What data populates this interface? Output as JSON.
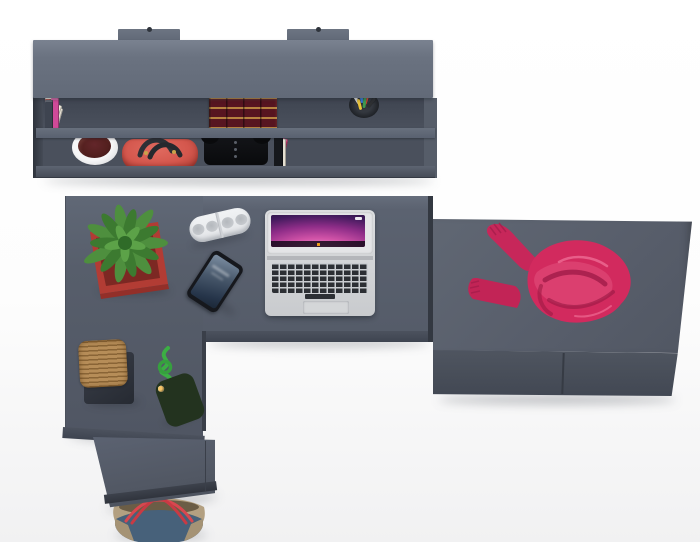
{
  "scene": {
    "type": "3d-furniture-render-top-view",
    "objects": [
      "wall-shelf-unit",
      "mount-brackets",
      "books",
      "classic-book-set",
      "pen-cup",
      "white-flower-pot",
      "red-handbag",
      "black-audio-device",
      "l-shaped-desk",
      "succulent-plant",
      "red-planter",
      "bluetooth-speaker",
      "macbook-laptop",
      "smartphone",
      "twine-stool",
      "bead-pouch-toy",
      "green-cord",
      "pedestal-cabinet",
      "tote-bag",
      "ottoman-cabinet",
      "pink-sweater"
    ]
  },
  "colors": {
    "bg": "#ffffff",
    "bg_floor": "#f1f1f2",
    "unit_top": "#6a7280",
    "surface": "#5b6270",
    "recess": "#4a505c",
    "edge": "#4c525e",
    "edge_dark": "#363b45",
    "classic_book": "#571520",
    "classic_gold": "#d6a64a",
    "pot_red": "#b23c34",
    "pot_red_dark": "#7c2823",
    "leaf1": "#4e8f3e",
    "leaf2": "#3c7a30",
    "leaf3": "#5ca248",
    "leaf4": "#2f6b28",
    "sweater": "#d22a5e",
    "sweater_dark": "#9c1a45",
    "sweater_hi": "#ee6b93",
    "bag_red": "#d4574d",
    "bag_handle": "#2d3036",
    "speaker_body": "#eceef0",
    "speaker_grille": "#c6c9cd",
    "laptop_body": "#d6d8da",
    "laptop_key": "#2c2f34",
    "phone_body": "#16181d",
    "twine": "#b68d58",
    "stool_base": "#30353e",
    "cord_green": "#3cae44",
    "tote_denim": "#47617a",
    "tote_tan": "#b3a081",
    "tote_handle": "#d8474f",
    "pot_white": "#f2f2f3",
    "pot_plant": "#54201f",
    "device_black": "#0e0f12",
    "screen_pink1": "#f4a8d8",
    "screen_pink2": "#d253a8",
    "screen_purple": "#8e2d88",
    "screen_deep": "#431b5e",
    "screen_dark": "#1c0f33"
  },
  "shelf": {
    "books_row1": [
      {
        "c": "#e9e4d6",
        "w": 7,
        "h": 34
      },
      {
        "c": "#7b52b2",
        "w": 8,
        "h": 32
      },
      {
        "c": "#9aa0a8",
        "w": 4,
        "h": 29
      },
      {
        "c": "#efe9dc",
        "w": 8,
        "h": 35
      },
      {
        "c": "#d9cfae",
        "w": 6,
        "h": 31
      },
      {
        "c": "#c0392f",
        "w": 5,
        "h": 33
      },
      {
        "c": "#2d3138",
        "w": 7,
        "h": 30
      },
      {
        "c": "#e8e3d8",
        "w": 7,
        "h": 27,
        "r": 16,
        "g": 4
      },
      {
        "c": "#ddd3bc",
        "w": 8,
        "h": 29,
        "r": 18
      },
      {
        "c": "#f0ead8",
        "w": 7,
        "h": 31,
        "r": 20
      },
      {
        "c": "#d04a98",
        "w": 8,
        "h": 35,
        "g": 6
      },
      {
        "c": "#c02e8a",
        "w": 6,
        "h": 33
      },
      {
        "c": "#684fa0",
        "w": 7,
        "h": 31
      },
      {
        "c": "#2e8f8a",
        "w": 6,
        "h": 34
      },
      {
        "c": "#3a5fae",
        "w": 7,
        "h": 30
      },
      {
        "c": "#e2d8c2",
        "w": 6,
        "h": 28
      },
      {
        "c": "#d98a3a",
        "w": 5,
        "h": 32
      },
      {
        "c": "#a33028",
        "w": 6,
        "h": 34
      },
      {
        "c": "#23262b",
        "w": 7,
        "h": 31
      },
      {
        "c": "#3e4450",
        "w": 8,
        "h": 33
      }
    ],
    "books_row2": [
      {
        "c": "#7a2e22",
        "w": 8,
        "h": 31
      },
      {
        "c": "#3e8a4f",
        "w": 7,
        "h": 29
      },
      {
        "c": "#2aa0a0",
        "w": 6,
        "h": 32
      },
      {
        "c": "#1f2328",
        "w": 7,
        "h": 30
      },
      {
        "c": "#8a5a2e",
        "w": 8,
        "h": 28
      },
      {
        "c": "#d9c27a",
        "w": 6,
        "h": 31
      },
      {
        "c": "#2e5fae",
        "w": 7,
        "h": 29
      },
      {
        "c": "#e8e4da",
        "w": 8,
        "h": 32
      },
      {
        "c": "#6b4a8a",
        "w": 6,
        "h": 29,
        "g": 4
      },
      {
        "c": "#23262b",
        "w": 9,
        "h": 33
      },
      {
        "c": "#9aa0a8",
        "w": 6,
        "h": 28
      },
      {
        "c": "#c23b6e",
        "w": 7,
        "h": 31,
        "r": 14
      },
      {
        "c": "#e5e0d2",
        "w": 8,
        "h": 29,
        "g": 4
      },
      {
        "c": "#1b2e5e",
        "w": 7,
        "h": 32
      },
      {
        "c": "#2a7fd8",
        "w": 8,
        "h": 30
      },
      {
        "c": "#16181c",
        "w": 9,
        "h": 33
      }
    ],
    "pens": [
      "#e8e8e8",
      "#3a7fd8",
      "#d84a3a",
      "#2e3033",
      "#e8c23a",
      "#3e9a4f"
    ]
  },
  "laptop": {
    "dock": [
      "#4a90e2",
      "#9b59b6",
      "#e74c3c",
      "#f1c40f",
      "#2ecc71",
      "#e67e22",
      "#1abc9c",
      "#ecf0f1",
      "#3498db",
      "#e84393",
      "#95a5a6",
      "#f39c12"
    ]
  },
  "beads": [
    "#d94436",
    "#3aa76d",
    "#f5d547",
    "#4a90d9",
    "#e27de2",
    "#ffffff",
    "#a43de2",
    "#f5923e",
    "#3ad4d4",
    "#d43a3a",
    "#7ed43a",
    "#f5c6c6",
    "#3a66b8",
    "#f5b63e",
    "#e25555",
    "#55c655",
    "#dddddd",
    "#b44ae2",
    "#f56666",
    "#4ab8d9",
    "#e8e83a",
    "#d96aa4",
    "#66d966",
    "#46566a",
    "#f0f0f0",
    "#e2833a",
    "#3aa4f5",
    "#d94ad9",
    "#8ef58e",
    "#f5c66a"
  ]
}
